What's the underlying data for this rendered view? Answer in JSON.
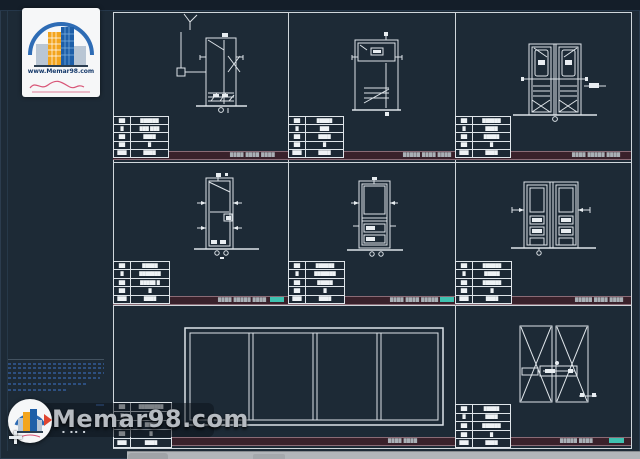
{
  "logo_card": {
    "url": "www.Memar98.com"
  },
  "watermark": {
    "text": "Memar98.com",
    "specks": "▪ ▪▪ ▪"
  },
  "strips": {
    "r1p1": "████ ████ ████",
    "r1p2": "█████ ████ ████",
    "r1p3": "████ █████ ████",
    "r2p1": "████ █████ ████",
    "r2p2": "████ ████ █████",
    "r2p3": "█████ ████ ████",
    "r3a": "████ ████",
    "r3b": "█████ ████"
  },
  "tables": {
    "r1p1": [
      [
        "██",
        "██████"
      ],
      [
        "█",
        "███ ███"
      ],
      [
        "██",
        "████"
      ],
      [
        "██",
        "█"
      ],
      [
        "███",
        "████"
      ]
    ],
    "r1p2": [
      [
        "██",
        "█████"
      ],
      [
        "█",
        "███"
      ],
      [
        "██",
        "████"
      ],
      [
        "██",
        "█"
      ],
      [
        "███",
        "████"
      ]
    ],
    "r1p3": [
      [
        "██",
        "██████"
      ],
      [
        "█",
        "████"
      ],
      [
        "██",
        "█████"
      ],
      [
        "██",
        "█"
      ],
      [
        "███",
        "████"
      ]
    ],
    "r2p1": [
      [
        "██",
        "█████"
      ],
      [
        "█",
        "███████"
      ],
      [
        "██",
        "█████ █"
      ],
      [
        "██",
        "█"
      ],
      [
        "███",
        "████"
      ]
    ],
    "r2p2": [
      [
        "██",
        "██████"
      ],
      [
        "█",
        "███████"
      ],
      [
        "██",
        "█████"
      ],
      [
        "██",
        "█"
      ],
      [
        "███",
        "████"
      ]
    ],
    "r2p3": [
      [
        "██",
        "██████"
      ],
      [
        "█",
        "█████"
      ],
      [
        "██",
        "██████"
      ],
      [
        "██",
        "█"
      ],
      [
        "███",
        "████"
      ]
    ],
    "r3l": [
      [
        "██",
        "████████"
      ],
      [
        "█",
        "█"
      ],
      [
        "██",
        "████"
      ],
      [
        "██",
        "█"
      ],
      [
        "███",
        "████"
      ]
    ],
    "r3r": [
      [
        "██",
        "█████"
      ],
      [
        "█",
        "████"
      ],
      [
        "██",
        "██████"
      ],
      [
        "██",
        "█"
      ],
      [
        "███",
        "████"
      ]
    ]
  },
  "colors": {
    "background": "#1d2a36",
    "line": "#dfe5ea",
    "title_strip": "#39212b",
    "highlight_teal": "#3fc1b0",
    "logo_orange": "#f3a51d",
    "logo_blue": "#1e5fa8",
    "signature_red": "#d85577"
  }
}
